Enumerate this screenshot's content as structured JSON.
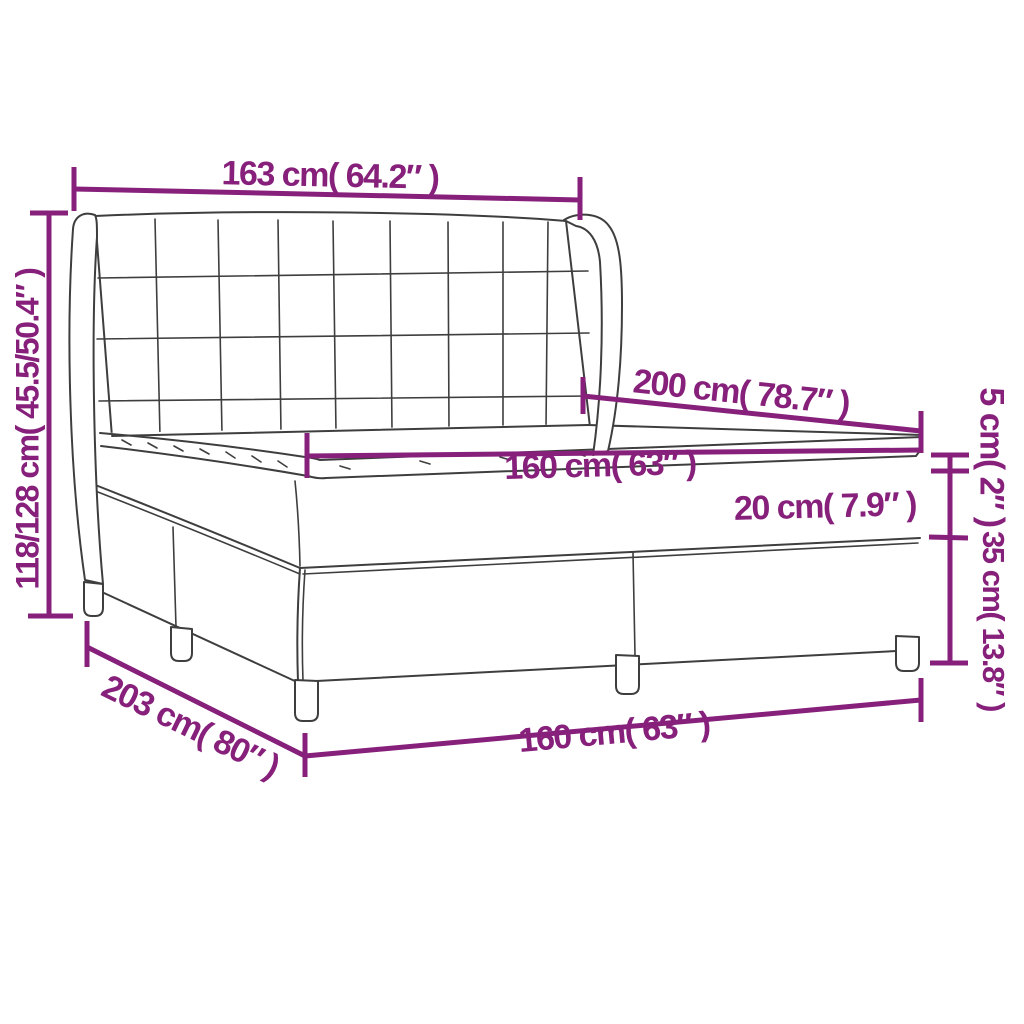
{
  "colors": {
    "accent": "#86207B",
    "line": "#3E3E3E",
    "background": "#FFFFFF"
  },
  "diagram": {
    "kind": "product-dimension-diagram",
    "subject": "box-spring-bed-with-tufted-wing-headboard-and-mattress-topper"
  },
  "labels": {
    "headboard_width": "163 cm( 64.2″ )",
    "overall_height": "118/128 cm( 45.5/50.4″ )",
    "length": "200 cm( 78.7″ )",
    "mattress_width": "160 cm( 63″ )",
    "mattress_thickness": "20 cm( 7.9″ )",
    "topper_thickness": "5 cm( 2″ )",
    "base_height": "35 cm( 13.8″ )",
    "overall_length": "203 cm( 80″ )",
    "base_width": "160 cm( 63″ )"
  },
  "measurements": [
    {
      "name": "headboard-width",
      "cm": "163",
      "inches": "64.2"
    },
    {
      "name": "overall-height",
      "cm": "118/128",
      "inches": "45.5/50.4"
    },
    {
      "name": "bed-length",
      "cm": "200",
      "inches": "78.7"
    },
    {
      "name": "mattress-width",
      "cm": "160",
      "inches": "63"
    },
    {
      "name": "mattress-thickness",
      "cm": "20",
      "inches": "7.9"
    },
    {
      "name": "topper-thickness",
      "cm": "5",
      "inches": "2"
    },
    {
      "name": "base-height",
      "cm": "35",
      "inches": "13.8"
    },
    {
      "name": "overall-length",
      "cm": "203",
      "inches": "80"
    },
    {
      "name": "base-width",
      "cm": "160",
      "inches": "63"
    }
  ]
}
